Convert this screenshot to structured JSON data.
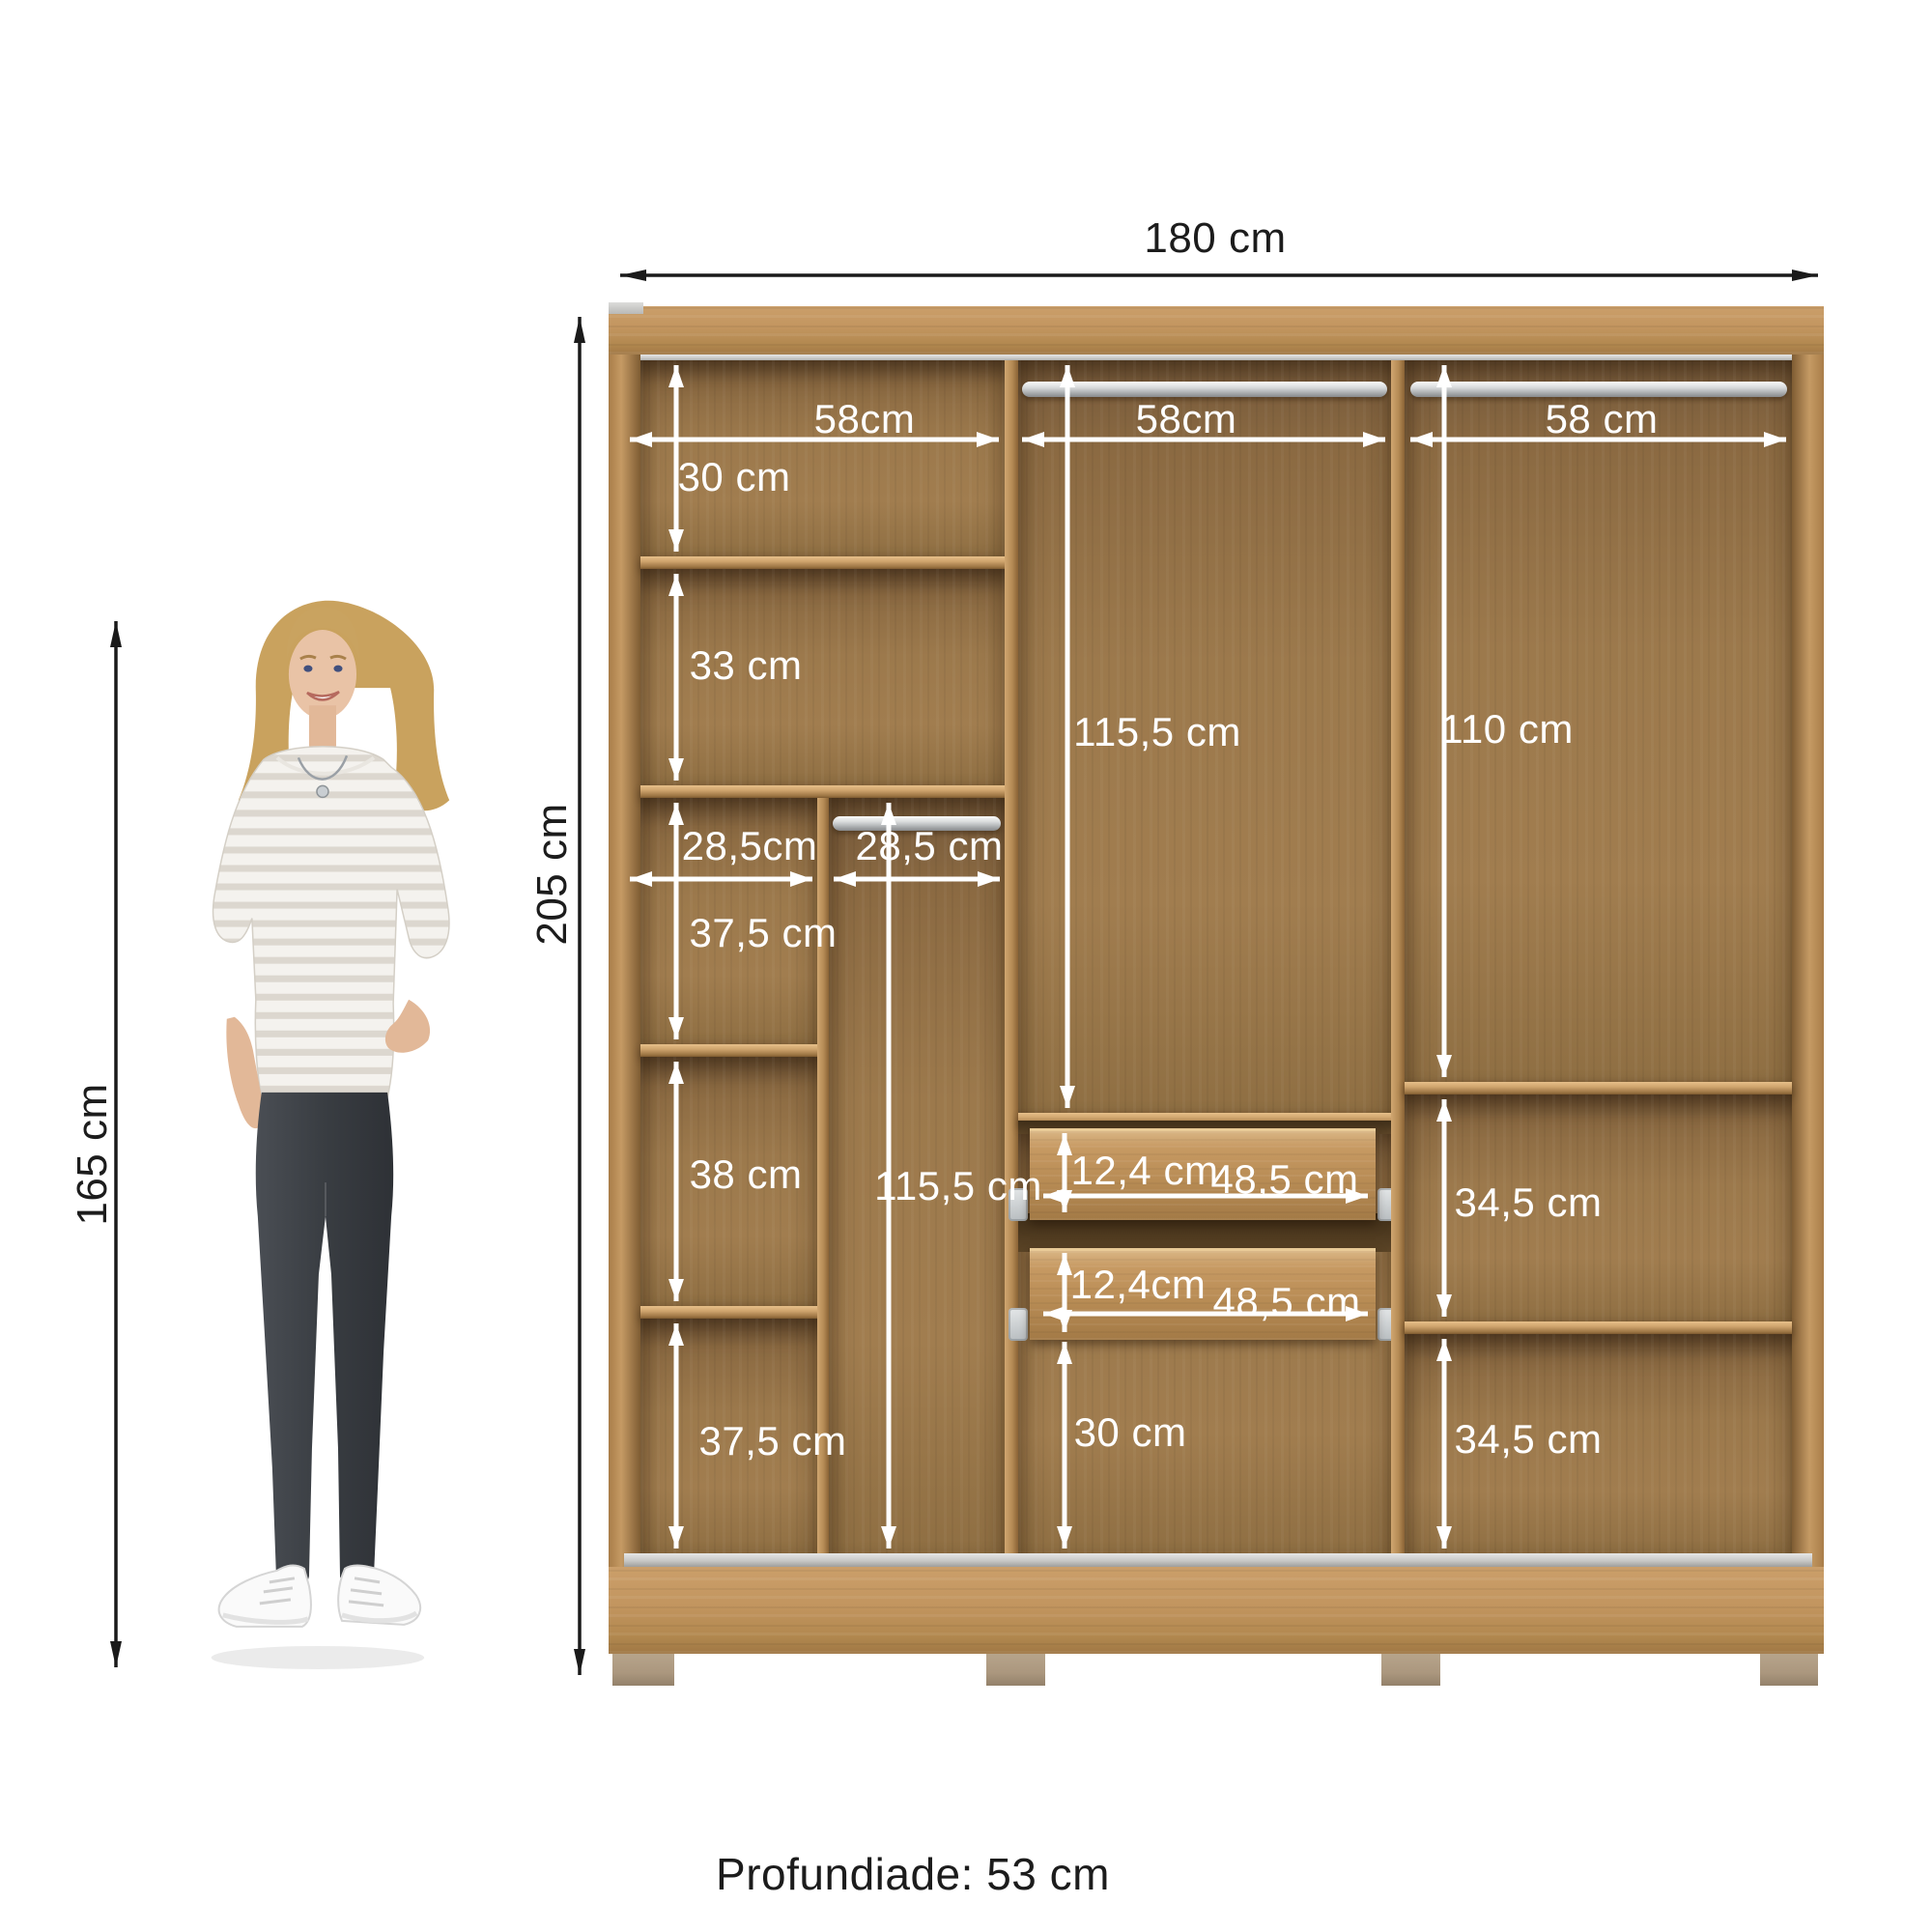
{
  "page": {
    "background": "#ffffff",
    "depth_note": "Profundiade: 53 cm"
  },
  "colors": {
    "wood_frame": "#c2955f",
    "wood_interior": "#9c794c",
    "wood_shelf_edge": "#e7c08a",
    "drawer_front": "#c79a63",
    "dim_arrow_outer": "#1a1a1a",
    "dim_arrow_inner": "#ffffff",
    "rod_metal": "#c9cbcd",
    "feet": "#b2a087"
  },
  "overall": {
    "width": "180 cm",
    "height": "205 cm",
    "person_height": "165 cm"
  },
  "sections": {
    "col1": {
      "width": "58cm",
      "top_shelf": "30 cm",
      "second_shelf": "33 cm",
      "left_sub_width": "28,5cm",
      "right_sub_width": "28,5 cm",
      "left_shelf_1": "37,5 cm",
      "left_shelf_2": "38 cm",
      "left_shelf_3": "37,5 cm",
      "right_hanging": "115,5 cm"
    },
    "col2": {
      "width": "58cm",
      "hanging": "115,5 cm",
      "drawer_1_height": "12,4 cm",
      "drawer_1_width": "48,5 cm",
      "drawer_2_height": "12,4cm",
      "drawer_2_width": "48,5 cm",
      "bottom": "30 cm"
    },
    "col3": {
      "width": "58 cm",
      "hanging": "110 cm",
      "shelf_1": "34,5 cm",
      "shelf_2": "34,5 cm"
    }
  }
}
